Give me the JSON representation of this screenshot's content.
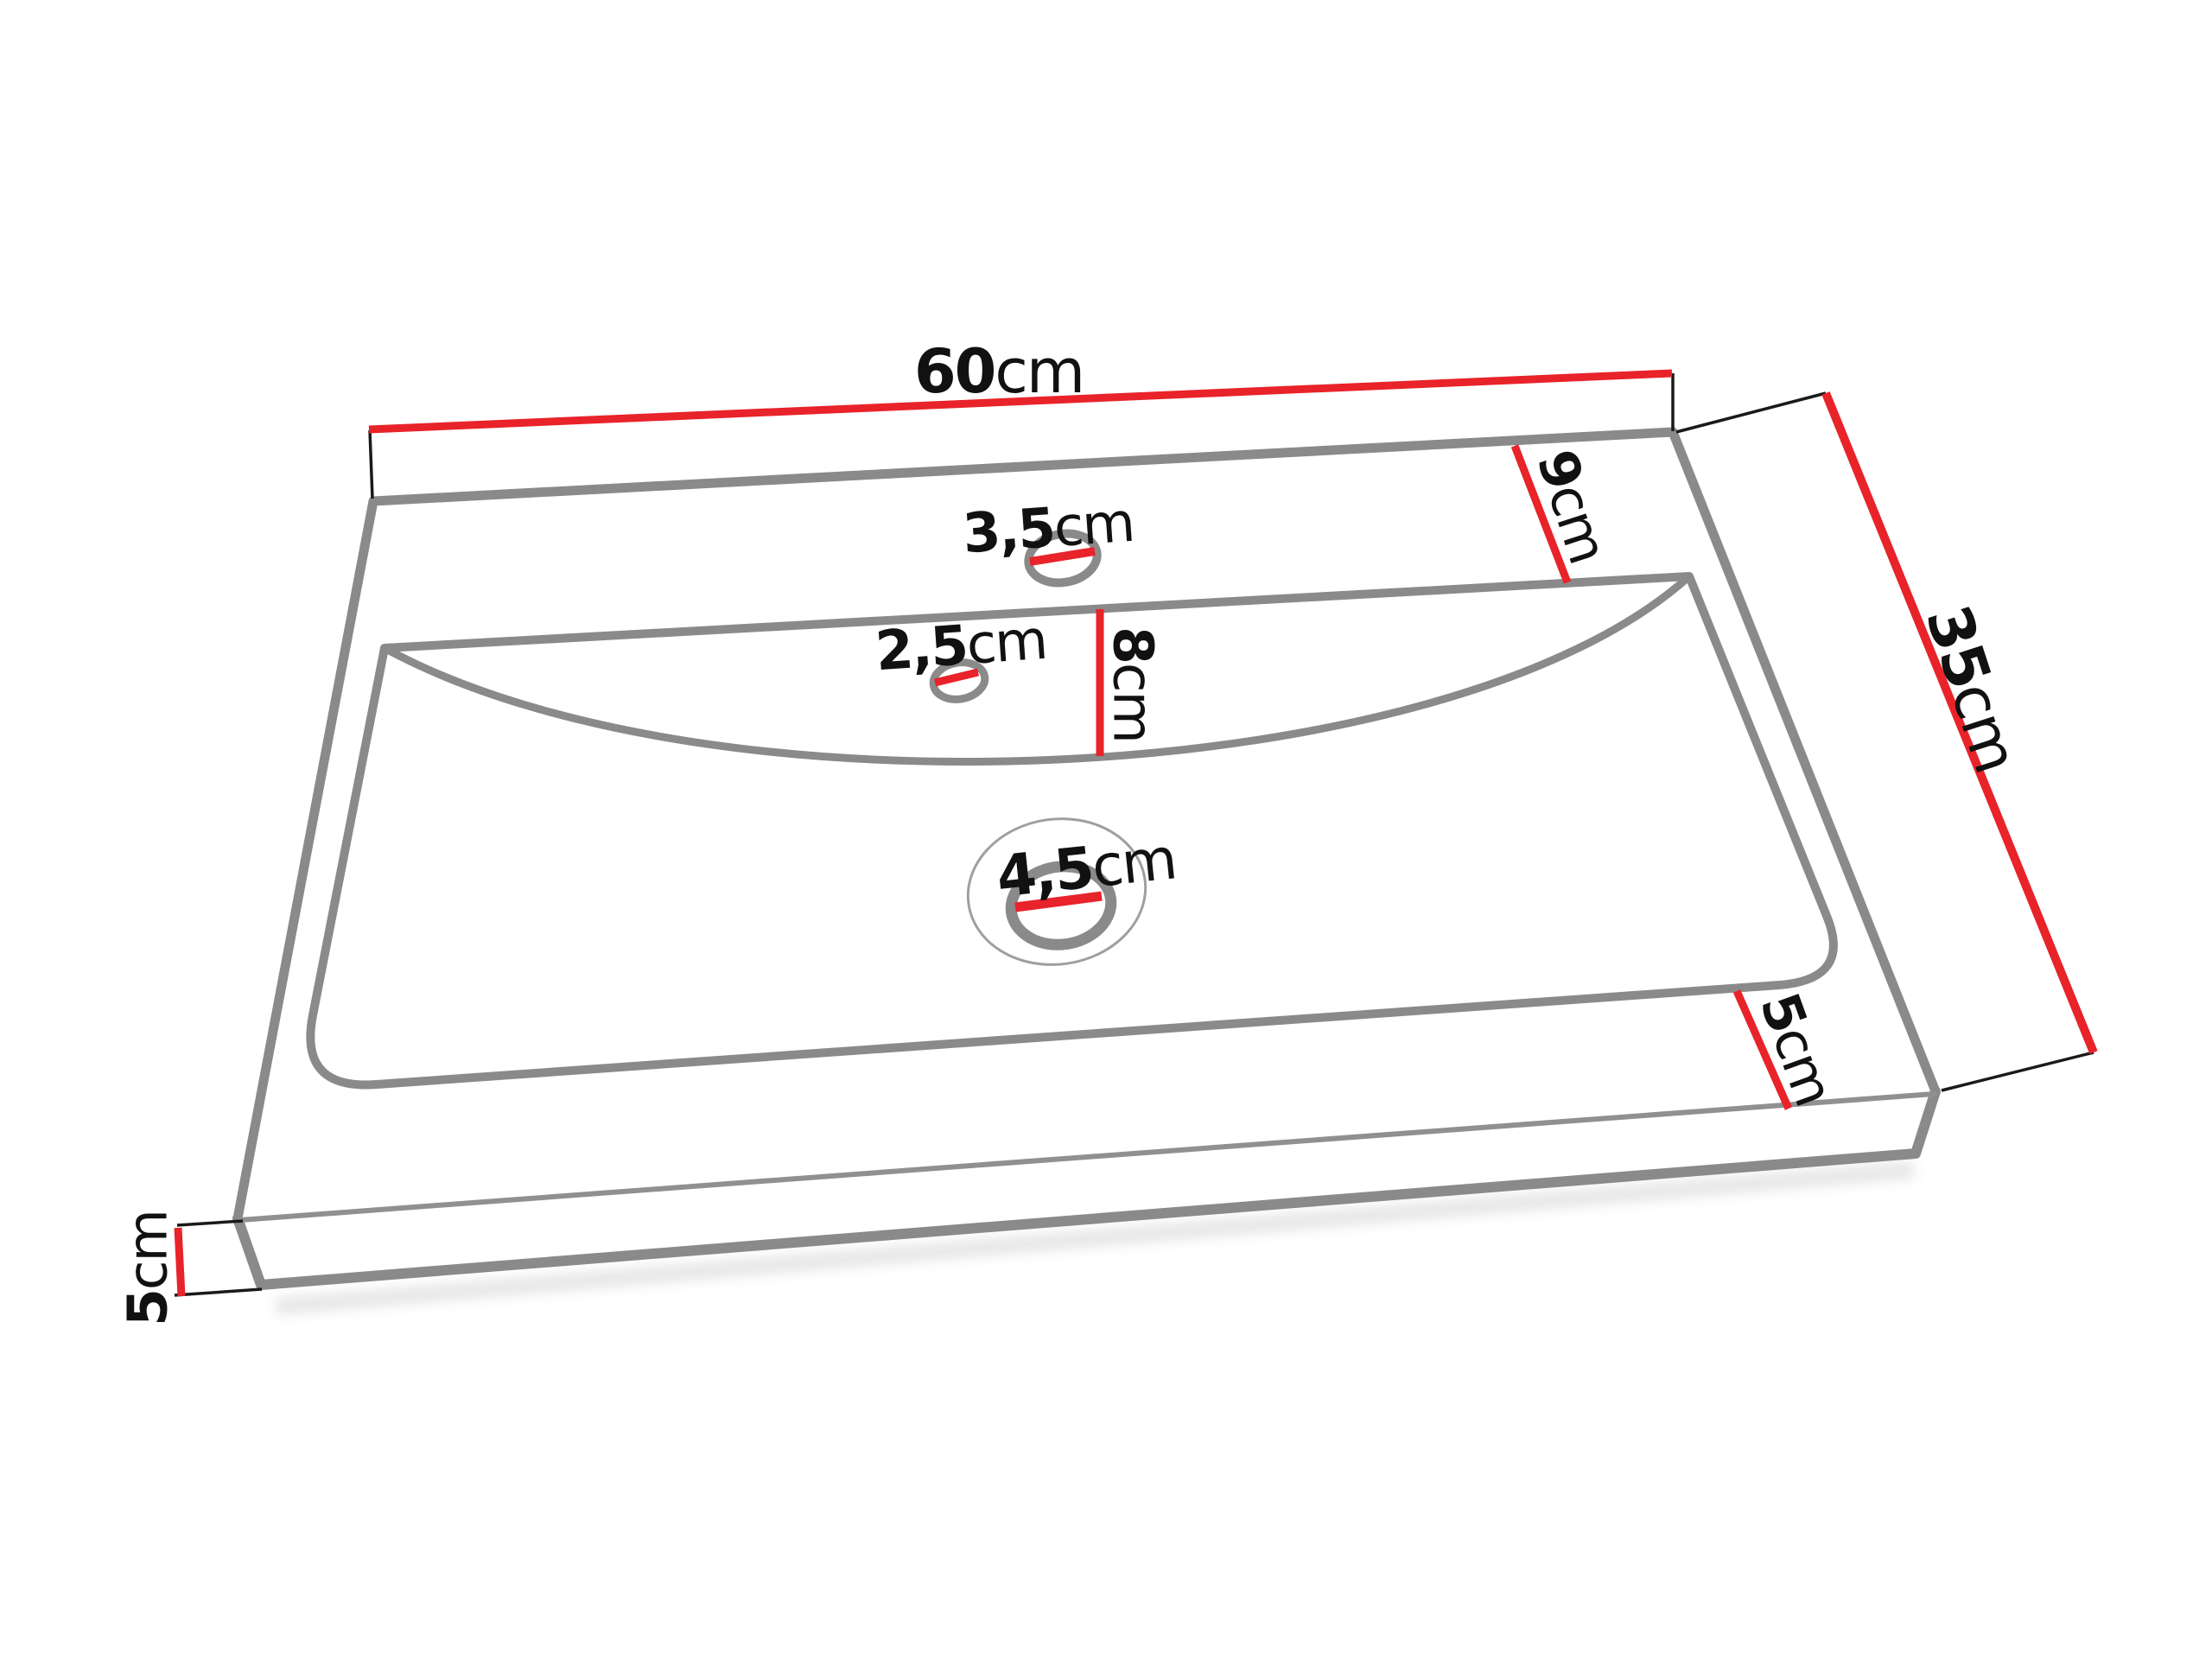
{
  "diagram": {
    "kind": "washbasin-technical-drawing",
    "unit": "cm",
    "dimensions": {
      "top_width": {
        "value": "60",
        "unit": "cm"
      },
      "depth": {
        "value": "35",
        "unit": "cm"
      },
      "back_ledge_width": {
        "value": "9",
        "unit": "cm"
      },
      "faucet_hole": {
        "value": "3,5",
        "unit": "cm"
      },
      "overflow_hole": {
        "value": "2,5",
        "unit": "cm"
      },
      "basin_depth": {
        "value": "8",
        "unit": "cm"
      },
      "drain_hole": {
        "value": "4,5",
        "unit": "cm"
      },
      "front_ledge_width": {
        "value": "5",
        "unit": "cm"
      },
      "slab_thickness": {
        "value": "5",
        "unit": "cm"
      }
    },
    "colors": {
      "dimension_line": "#e8232a",
      "outline": "#8a8a8a",
      "tick": "#1a1a1a",
      "text": "#111111",
      "background": "#ffffff"
    }
  }
}
